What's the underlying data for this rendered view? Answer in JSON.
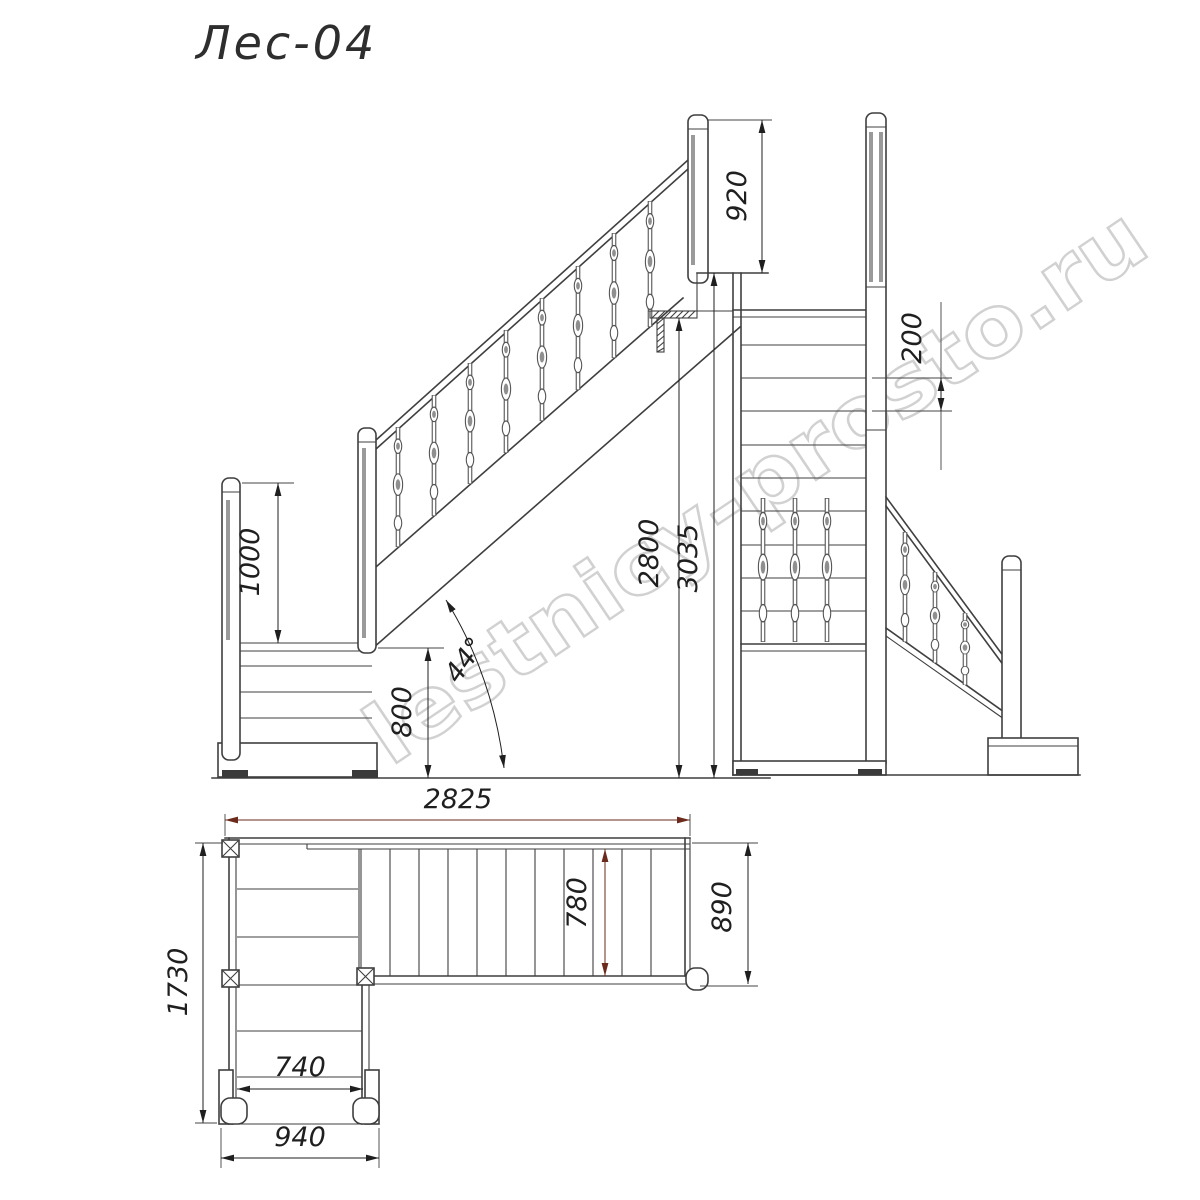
{
  "title": "Лес-04",
  "watermark": "lestnicy-prosto.ru",
  "views": {
    "side_elevation": {
      "dimensions": {
        "railing_height_top": "920",
        "railing_height_landing": "1000",
        "landing_height": "800",
        "floor_height": "2800",
        "total_height": "3035",
        "incline_angle": "44°"
      }
    },
    "front_elevation": {
      "dimensions": {
        "step_rise": "200"
      }
    },
    "plan": {
      "dimensions": {
        "total_length": "2825",
        "tread_width": "780",
        "flight_width": "890",
        "plan_depth": "1730",
        "lower_tread_width": "740",
        "lower_flight_width": "940"
      }
    }
  },
  "colors": {
    "line": "#3f3f3f",
    "dimension": "#1f1f1f",
    "accent_arrow": "#6b2a1c",
    "watermark": "#c9c9c9"
  }
}
